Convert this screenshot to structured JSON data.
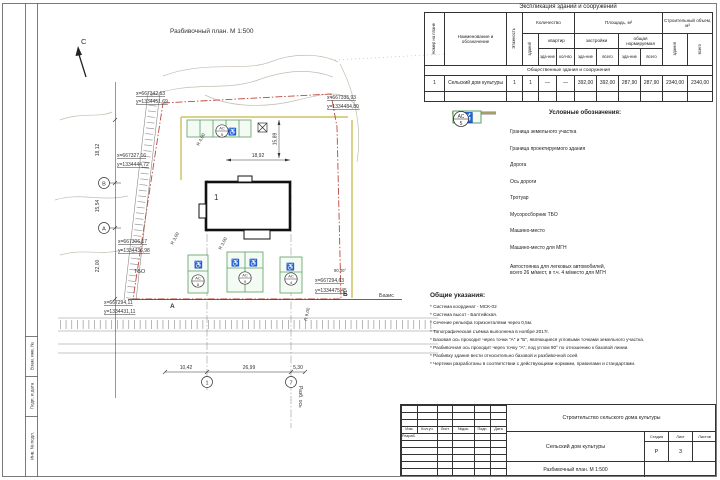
{
  "sheet": {
    "side_labels": [
      "Взам. инв. №",
      "Подп. и дата",
      "Инв. № подл."
    ]
  },
  "plan": {
    "title": "Разбивочный план. М 1:500",
    "north": "С",
    "bld_no": "1",
    "axis_b": "В",
    "axis_a": "А",
    "grid_1": "1",
    "grid_7": "7",
    "point_a": "А",
    "point_b": "Б",
    "tbo": "ТБО",
    "bazis": "Базис",
    "razb": "Разб. ось",
    "ac_label": "АС",
    "ac_counts": [
      "5",
      "8",
      "9",
      "4"
    ],
    "dims": {
      "top": "18,92",
      "right": "15,89",
      "r4": "R 4,00",
      "r3a": "R 3,00",
      "r3b": "R 3,00",
      "r9": "R 9,00",
      "b1": "10,42",
      "b2": "26,99",
      "b3": "5,30",
      "l1": "18,12",
      "l2": "15,54",
      "l3": "22,00",
      "angle": "90,00°"
    },
    "coords": [
      {
        "x": "x=667342,63",
        "y": "y=1334451,69"
      },
      {
        "x": "x=667335,93",
        "y": "y=1334484,80"
      },
      {
        "x": "x=667327,16",
        "y": "y=1334444,72"
      },
      {
        "x": "x=667306,17",
        "y": "y=1334436,98"
      },
      {
        "x": "x=667294,11",
        "y": "y=1334431,11"
      },
      {
        "x": "x=667294,63",
        "y": "y=1334475,45"
      }
    ]
  },
  "icons": {
    "wheelchair": "♿"
  },
  "colors": {
    "boundary_red": "#bb4a3c",
    "parking_green": "#5f9e63",
    "sidewalk_yellow": "#d8ce7e"
  },
  "table": {
    "title": "Экспликация зданий и сооружений",
    "col_num": "Номер на плане",
    "col_name": "Наименование и обозначение",
    "col_floors": "Этажность",
    "grp_qty": "Количество",
    "col_bld": "зданий",
    "grp_apt": "квартир",
    "col_apt_bld": "зда-ние",
    "col_apt_qty": "кол-во",
    "grp_area": "Площадь, м²",
    "grp_built": "застройки",
    "grp_norm": "общая нормируемая",
    "col_b_bld": "зда-ние",
    "col_b_all": "всего",
    "col_n_bld": "зда-ние",
    "col_n_all": "всего",
    "grp_vol": "Строительный объем, м³",
    "col_v_bld": "здания",
    "col_v_all": "всего",
    "section": "Общественные здания и сооружения",
    "row": [
      "1",
      "Сельский дом культуры",
      "1",
      "1",
      "—",
      "—",
      "392,00",
      "392,00",
      "287,90",
      "287,90",
      "2340,00",
      "2340,00"
    ]
  },
  "legend": {
    "title": "Условные обозначения:",
    "items": [
      "Граница земельного участка",
      "Граница проектируемого здания",
      "Дорога",
      "Ось дороги",
      "Тротуар",
      "Мусоросборник ТБО",
      "Машино-место",
      "Машино-место для МГН"
    ],
    "parking_line1": "Автостоянка для легковых автомобилей,",
    "parking_line2": "всего 26 м/мест, в т.ч. 4 м/место для МГН",
    "ac_top": "АС",
    "ac_bottom": "5"
  },
  "notes": {
    "title": "Общие указания:",
    "lines": [
      "* Система координат - МСК-02",
      "* Система высот - Балтийская.",
      "* Сечение рельефа горизонталями через 0,5м.",
      "* Топографическая съёмка выполнена в ноябре 2017г.",
      "* Базовая ось проходит через точки \"А\" и \"Б\", являющиеся угловыми точками земельного участка.",
      "* Разбивочная ось проходит через точку \"А\", под углом 90° по отношению к базовой линии.",
      "* Разбивку здания вести относительно базовой и разбивочной осей.",
      "* Чертежи разработаны в соответствии с действующими нормами, правилами и стандартами."
    ]
  },
  "stamp": {
    "project": "Строительство сельского дома культуры",
    "object": "Сельский дом культуры",
    "doc": "Разбивочный план. М 1:500",
    "header_cols": [
      "Изм.",
      "Кол.уч.",
      "Лист",
      "№док.",
      "Подп.",
      "Дата"
    ],
    "razrab": "Разраб.",
    "stage_label": "Стадия",
    "sheet_label": "Лист",
    "sheets_label": "Листов",
    "stage": "Р",
    "sheet_no": "3",
    "sheets": ""
  }
}
